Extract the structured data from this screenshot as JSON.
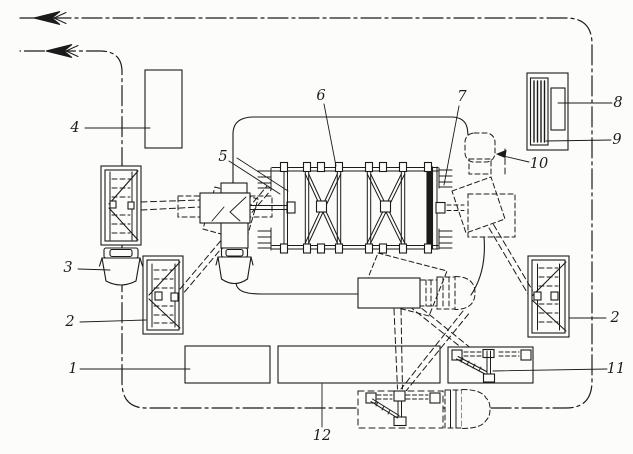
{
  "diagram": {
    "kind": "technical plan schematic of assembly yard",
    "ink_color": "#1b1b1b",
    "paper_color": "#fcfcfa",
    "route": {
      "line_style": "dash-dot",
      "arrow_direction": "left",
      "arrow_count": 2
    },
    "labels": [
      {
        "id": "1",
        "text": "1"
      },
      {
        "id": "2-left",
        "text": "2"
      },
      {
        "id": "3",
        "text": "3"
      },
      {
        "id": "4",
        "text": "4"
      },
      {
        "id": "5",
        "text": "5"
      },
      {
        "id": "6",
        "text": "6"
      },
      {
        "id": "7",
        "text": "7"
      },
      {
        "id": "8",
        "text": "8"
      },
      {
        "id": "9",
        "text": "9"
      },
      {
        "id": "10",
        "text": "10"
      },
      {
        "id": "11",
        "text": "11"
      },
      {
        "id": "2-right",
        "text": "2"
      },
      {
        "id": "12",
        "text": "12"
      }
    ]
  }
}
